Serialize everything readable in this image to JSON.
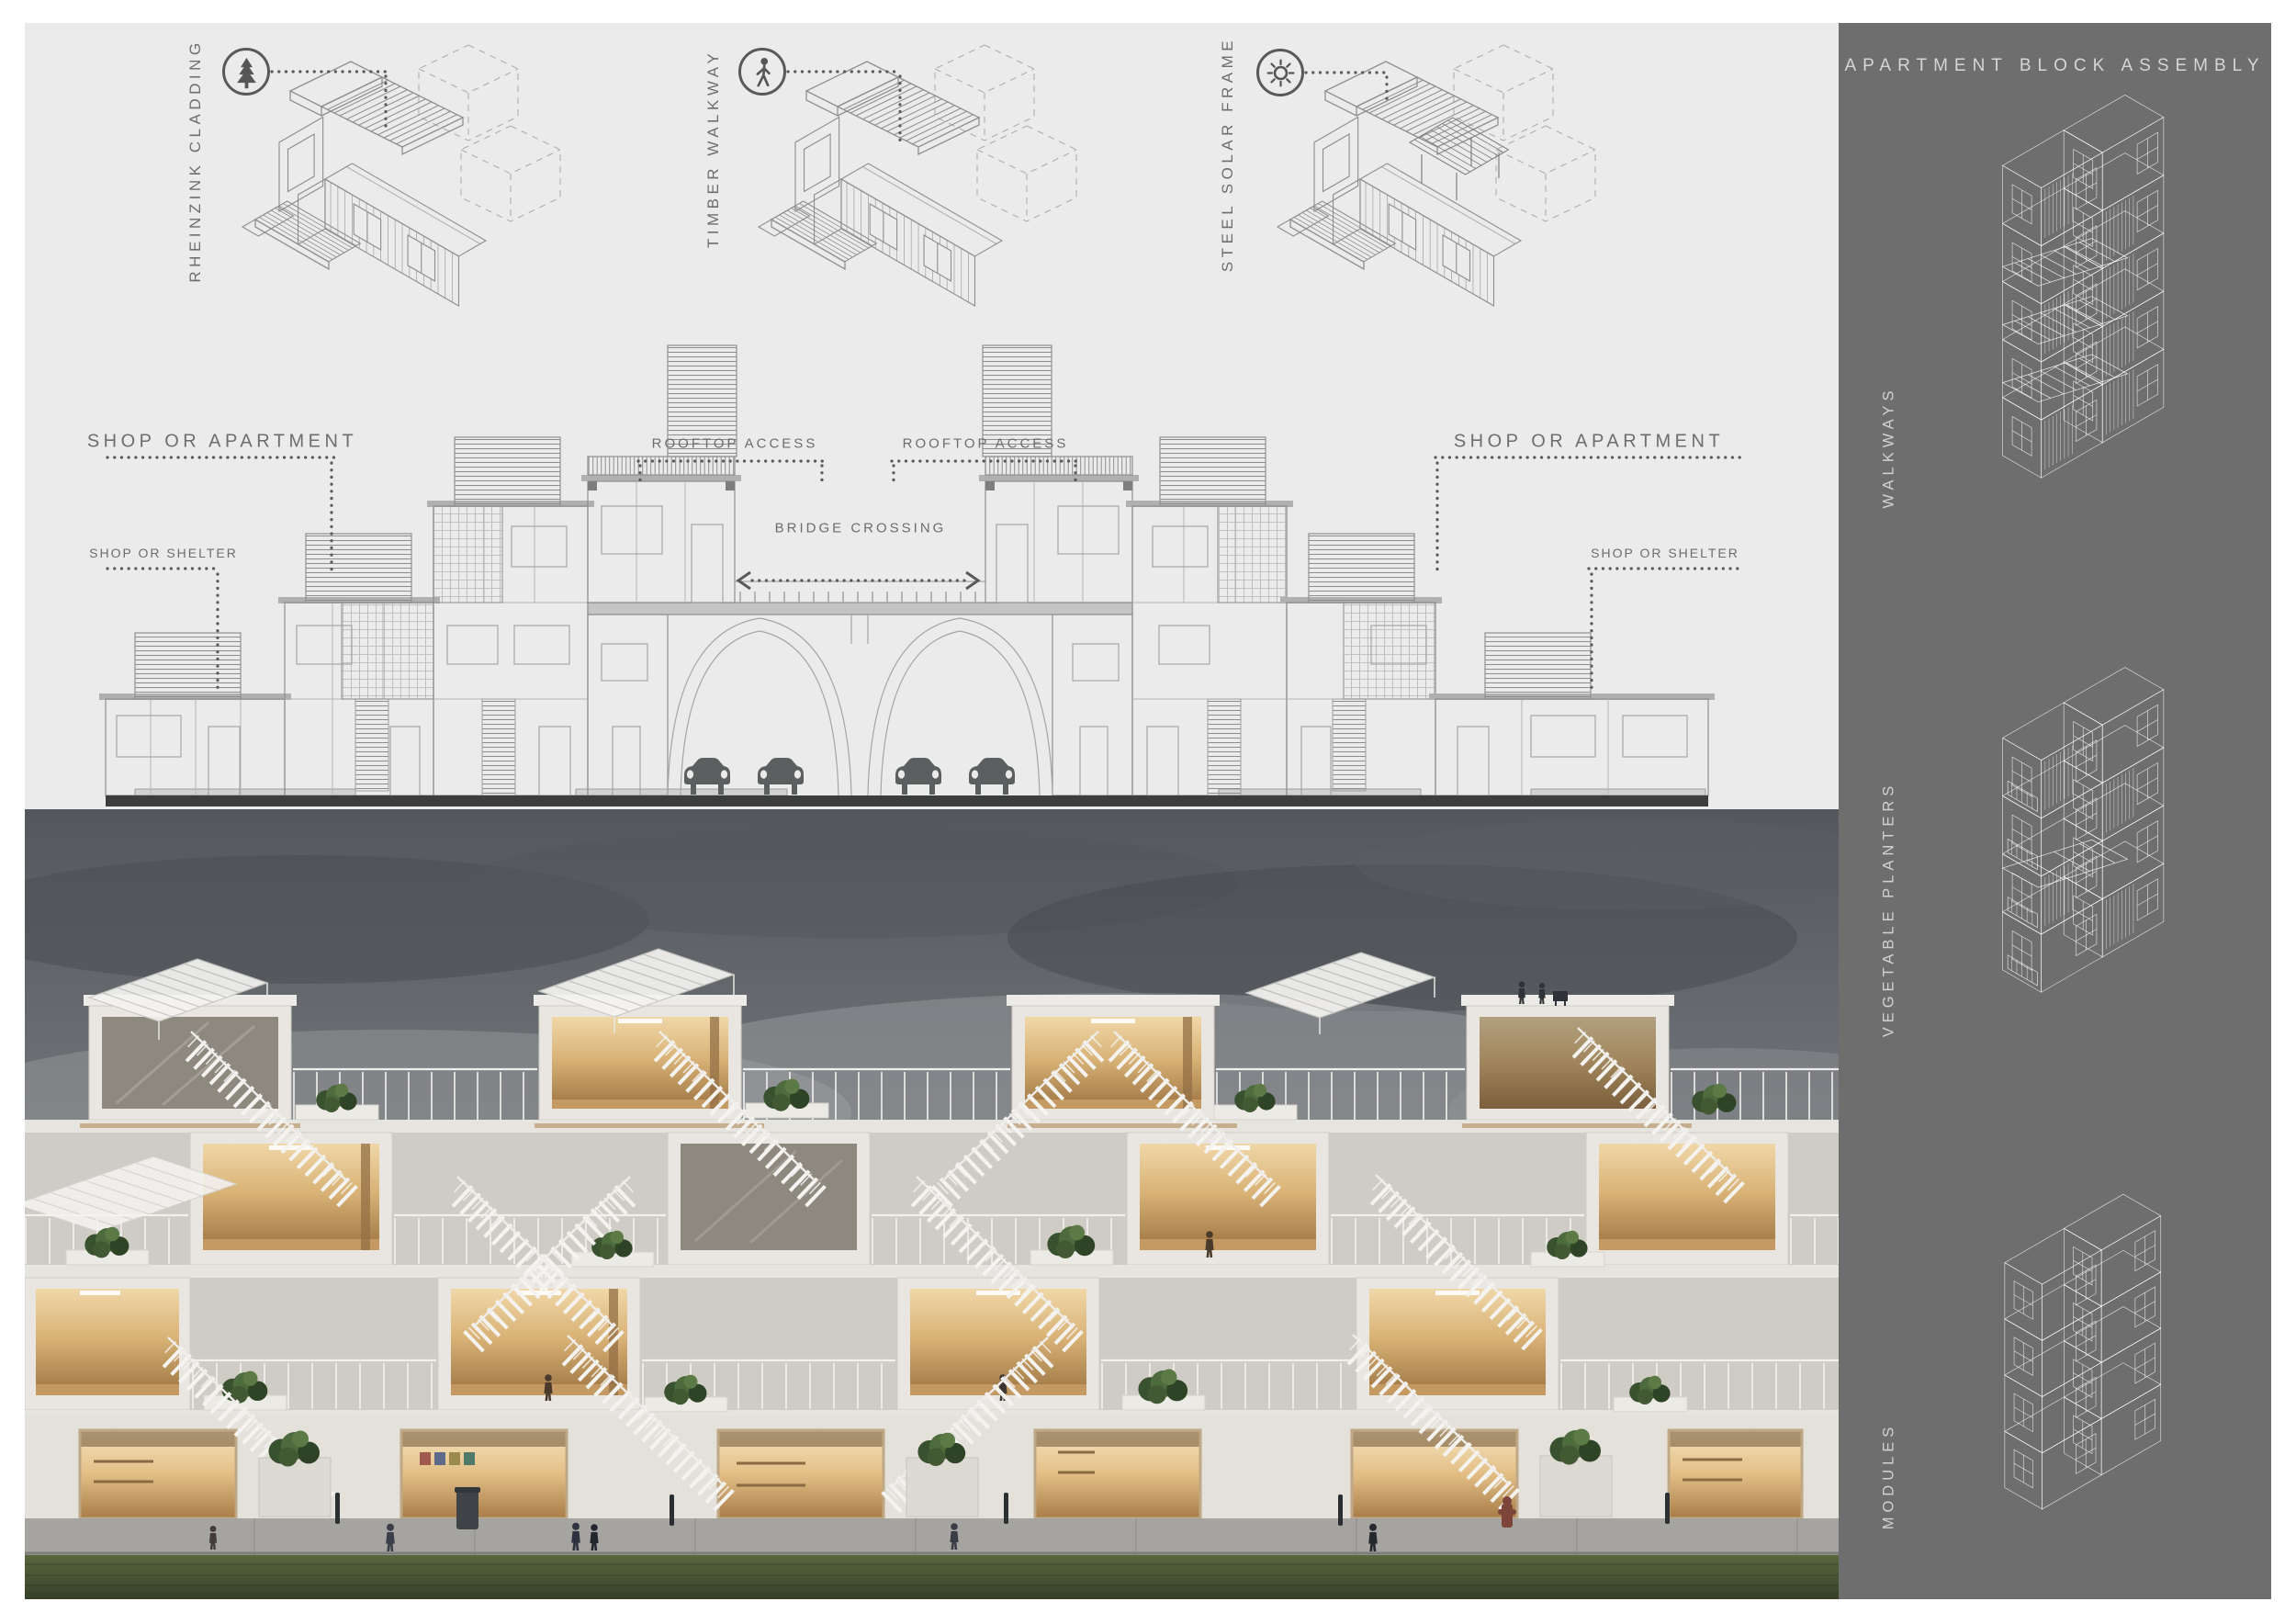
{
  "board": {
    "diagrams": [
      {
        "label": "RHEINZINK CLADDING",
        "icon": "tree-icon"
      },
      {
        "label": "TIMBER WALKWAY",
        "icon": "pedestrian-icon"
      },
      {
        "label": "STEEL SOLAR FRAME",
        "icon": "sun-icon"
      }
    ],
    "elevation": {
      "shop_or_apartment_left": "SHOP OR APARTMENT",
      "shop_or_apartment_right": "SHOP OR APARTMENT",
      "rooftop_access_left": "ROOFTOP ACCESS",
      "rooftop_access_right": "ROOFTOP ACCESS",
      "bridge_crossing": "BRIDGE CROSSING",
      "shop_or_shelter_left": "SHOP OR SHELTER",
      "shop_or_shelter_right": "SHOP OR SHELTER"
    },
    "sidebar": {
      "title": "APARTMENT BLOCK ASSEMBLY",
      "figures": [
        {
          "label": "WALKWAYS"
        },
        {
          "label": "VEGETABLE PLANTERS"
        },
        {
          "label": "MODULES"
        }
      ]
    },
    "colors": {
      "panel_bg": "#ebebec",
      "sidebar_bg": "#6e6e6f",
      "line_art": "#8f8f8f",
      "label_text": "#6d6d6d",
      "sidebar_text": "#d2d2d2",
      "ground": "#3c3e3e",
      "warm_light": "#d9b377",
      "plant_green": "#4d6b3c",
      "lawn_green": "#4a5735",
      "sky_gray": "#54575c"
    }
  }
}
